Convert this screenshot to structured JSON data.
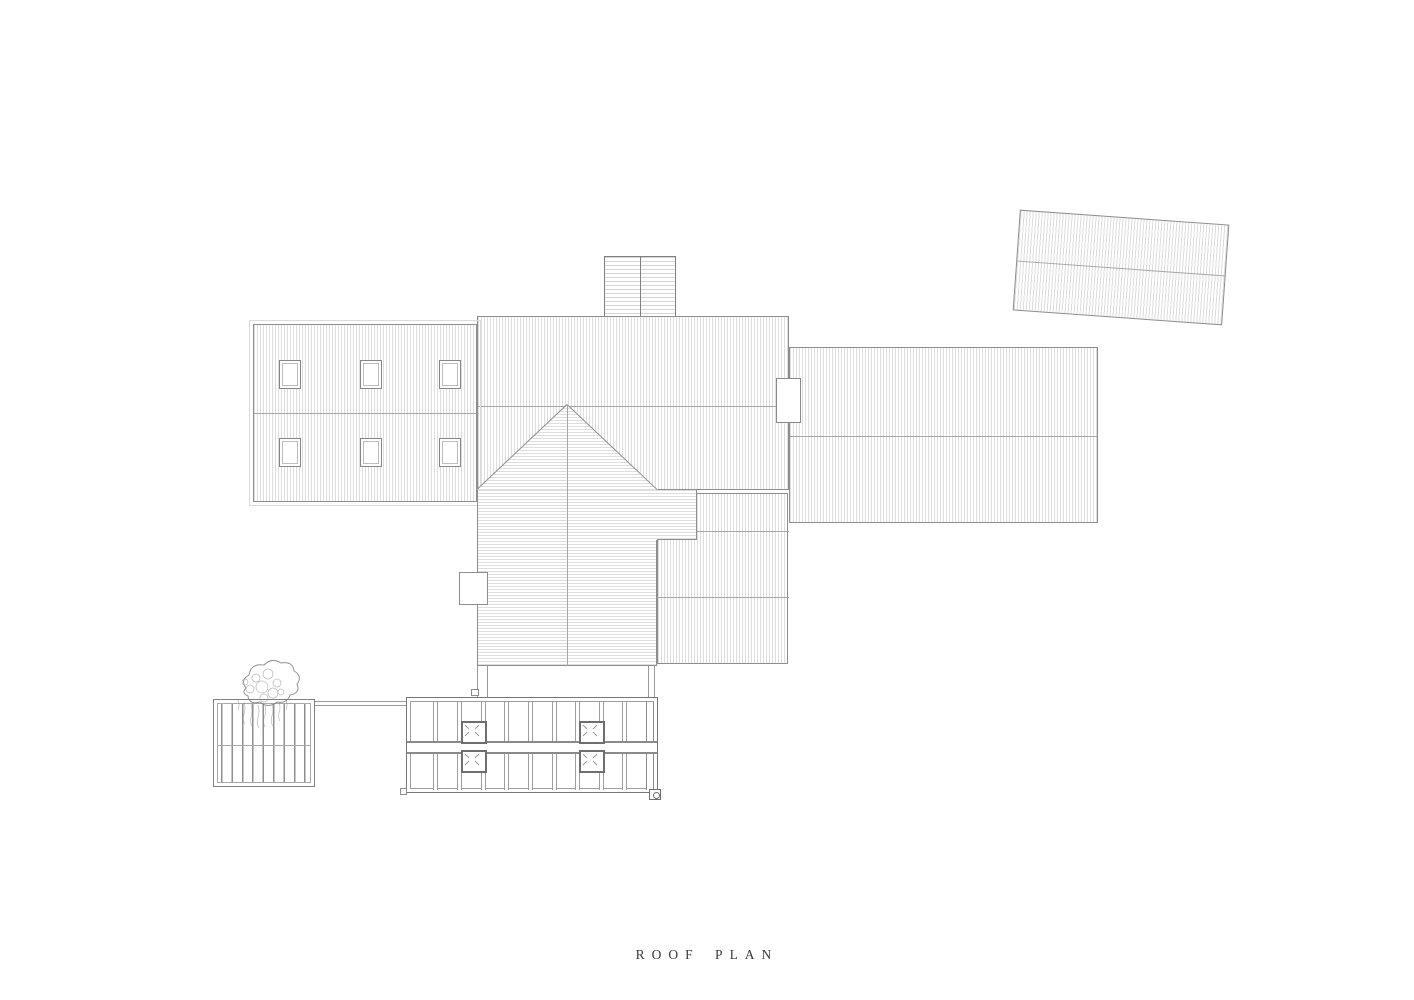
{
  "title": {
    "text": "ROOF PLAN"
  },
  "palette": {
    "background": "#ffffff",
    "outline": "#8e8e8e",
    "hatch": "#d7d7d7",
    "ridge": "#a6a6a6",
    "glazing_frame": "#767676",
    "title_text": "#3a3a3a"
  }
}
